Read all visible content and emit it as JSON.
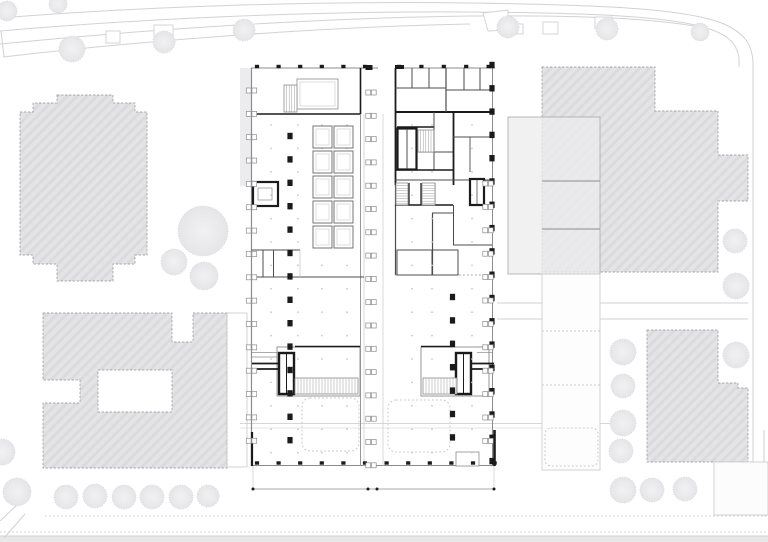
{
  "canvas": {
    "width": 768,
    "height": 542,
    "background": "#ffffff"
  },
  "colors": {
    "background": "#ffffff",
    "building_fill": "#e4e4e6",
    "building_stroke": "#a8a8ac",
    "overlay_fill": "#ececee",
    "road_line": "#d2d2d4",
    "tree_fill": "#eeeeef",
    "tree_edge": "#dbdbdd",
    "wall_black": "#1b1b1b",
    "wall_medium": "#4c4c4e",
    "line_thin": "#8c8c8e",
    "line_faint": "#c9c9cb",
    "hatch_line": "#9a9a9c",
    "band_fill": "#e8e8e9"
  },
  "site": {
    "trees": [
      [
        7,
        11,
        10
      ],
      [
        58,
        4,
        9
      ],
      [
        72,
        49,
        13
      ],
      [
        164,
        42,
        11
      ],
      [
        244,
        30,
        11
      ],
      [
        508,
        27,
        11
      ],
      [
        607,
        29,
        11
      ],
      [
        700,
        32,
        9
      ],
      [
        203,
        231,
        25
      ],
      [
        174,
        262,
        13
      ],
      [
        204,
        276,
        14
      ],
      [
        735,
        241,
        12
      ],
      [
        736,
        286,
        13
      ],
      [
        736,
        355,
        13
      ],
      [
        623,
        352,
        13
      ],
      [
        623,
        386,
        12
      ],
      [
        623,
        423,
        13
      ],
      [
        621,
        451,
        12
      ],
      [
        623,
        490,
        13
      ],
      [
        652,
        490,
        12
      ],
      [
        685,
        489,
        12
      ],
      [
        2,
        452,
        13
      ],
      [
        17,
        492,
        14
      ],
      [
        66,
        497,
        12
      ],
      [
        95,
        496,
        12
      ],
      [
        124,
        497,
        12
      ],
      [
        152,
        497,
        12
      ],
      [
        181,
        497,
        12
      ],
      [
        208,
        496,
        11
      ]
    ],
    "road_stubs": [
      [
        106,
        31,
        14,
        12
      ],
      [
        154,
        25,
        19,
        12
      ],
      [
        510,
        24,
        13,
        10
      ],
      [
        543,
        22,
        15,
        12
      ],
      [
        595,
        17,
        17,
        12
      ]
    ]
  },
  "plan": {
    "facade_ticks": [
      {
        "axis": "h",
        "y": 66.5,
        "x0": 257,
        "step": 21.6,
        "count": 6
      },
      {
        "axis": "h",
        "y": 66.5,
        "x0": 399,
        "step": 22.4,
        "count": 5
      },
      {
        "axis": "h",
        "y": 463.0,
        "x0": 257,
        "step": 21.6,
        "count": 12
      }
    ],
    "columns": [
      {
        "x": 290,
        "y0": 136,
        "step": 23.4,
        "count": 14
      },
      {
        "x": 452.5,
        "y0": 297,
        "step": 23.4,
        "count": 7
      },
      {
        "x": 492,
        "y0": 65,
        "step": 23.3,
        "count": 18
      }
    ],
    "markers": [
      {
        "x": 251.5,
        "y0": 88,
        "step": 23.35,
        "count": 16
      },
      {
        "x": 371,
        "y0": 90,
        "step": 23.3,
        "count": 17
      },
      {
        "x": 488,
        "y0": 181,
        "step": 23.4,
        "count": 12
      }
    ],
    "grid_dots": {
      "xs": [
        271,
        298,
        322,
        347,
        412,
        432,
        472
      ],
      "y0": 125,
      "step": 23.4,
      "count": 15
    },
    "parking": {
      "x": 313,
      "cell_w": 19,
      "gap": 2,
      "h": 22,
      "rows": [
        126,
        151,
        176,
        201,
        226
      ]
    },
    "stair_hatches": [
      {
        "x": 284,
        "y": 85,
        "w": 13,
        "h": 27,
        "dir": "v",
        "step": 2.6
      },
      {
        "x": 418,
        "y": 130,
        "w": 16,
        "h": 22,
        "dir": "v",
        "step": 2.6
      },
      {
        "x": 396,
        "y": 183,
        "w": 12,
        "h": 22,
        "dir": "h",
        "step": 2.6
      },
      {
        "x": 422,
        "y": 183,
        "w": 13,
        "h": 22,
        "dir": "h",
        "step": 2.6
      },
      {
        "x": 295,
        "y": 378,
        "w": 63,
        "h": 16,
        "dir": "v",
        "step": 3
      },
      {
        "x": 423,
        "y": 378,
        "w": 34,
        "h": 16,
        "dir": "v",
        "step": 3
      }
    ]
  }
}
